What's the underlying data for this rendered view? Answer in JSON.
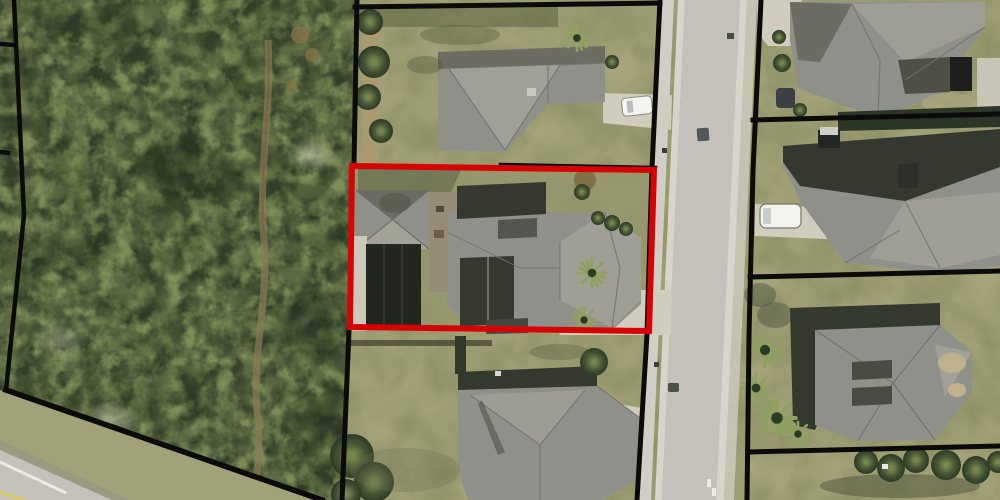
{
  "meta": {
    "view": "aerial-parcel-map",
    "description": "Aerial/satellite imagery of a residential street with GIS parcel boundary overlay; one parcel highlighted in red"
  },
  "palette": {
    "boundary_black": "#0b0b0b",
    "boundary_red": "#d60404",
    "lawn": "#9a9b70",
    "lawn_subject": "#94966b",
    "forest_base": "#5a6841",
    "forest_dark": "#33402a",
    "forest_light": "#83945a",
    "road": "#c3c1b9",
    "road_curb": "#d7d5cb",
    "sidewalk": "#d1cfc5",
    "concrete": "#d0cdbf",
    "roof_main": "#90908a",
    "roof_light": "#a4a398",
    "roof_dark": "#35382f",
    "roof_shade": "#6c6c63",
    "pool_dark": "#23261f",
    "hedge_dark": "#2c3627",
    "vehicle_white": "#f3f3ef",
    "marking_white": "#ebebe2",
    "marking_yellow": "#d9c96c",
    "dirt_trail": "#8b7a55",
    "dirt_sand": "#b09a6e",
    "palm_dark": "#2c3b24",
    "palm_light": "#9cac6c"
  },
  "features": {
    "selected_parcel": {
      "name": "selected-parcel",
      "highlight_color": "#d60404"
    },
    "parcel_lines": {
      "name": "parcel-boundary-lines",
      "color": "#0b0b0b"
    },
    "street": {
      "name": "street-north-south"
    },
    "street_sw": {
      "name": "street-southwest-corner"
    },
    "woods": {
      "name": "wooded-parcel-west"
    },
    "houses": [
      "house-north",
      "house-subject",
      "house-south",
      "house-east-north",
      "house-east-middle",
      "house-east-south"
    ],
    "vehicles": [
      "white-car-driveway-north",
      "white-van-driveway-east"
    ]
  }
}
